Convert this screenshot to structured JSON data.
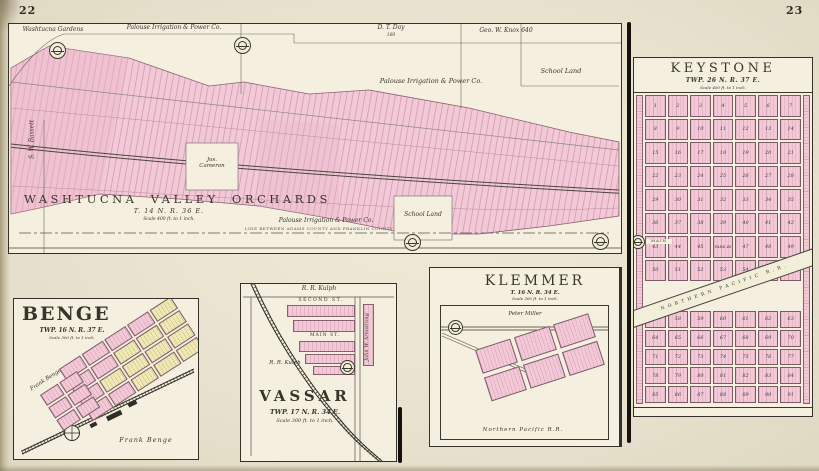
{
  "page": {
    "left_number": "22",
    "right_number": "23"
  },
  "colors": {
    "paper": "#e8e2cf",
    "panel": "#f4efdf",
    "pink": "#f3c9d7",
    "pink_dark": "#eab6c9",
    "yellow": "#efe9b6",
    "ink": "#2e2c24"
  },
  "washtucna": {
    "title": "WASHTUCNA  VALLEY  ORCHARDS",
    "township": "T. 14 N. R. 36 E.",
    "scale": "Scale 400 ft. to 1 inch.",
    "labels": {
      "washtucna_gardens": "Washtucna  Gardens",
      "palouse_top": "Palouse Irrigation & Power Co.",
      "dt_day": "D. T. Day",
      "dt_day_acres": "160",
      "geo_knox": "Geo. W. Knox   640",
      "palouse_mid": "Palouse  Irrigation  &  Power  Co.",
      "school_land_right": "School  Land",
      "jos_cameron_1": "Jos.",
      "jos_cameron_2": "Cameron",
      "school_land_bottom": "School  Land",
      "palouse_bottom": "Palouse Irrigation & Power Co.",
      "sw_bassett": "S. W. Bassett",
      "county_line": "LINE BETWEEN ADAMS COUNTY AND FRANKLIN COUNTY"
    }
  },
  "keystone": {
    "title": "KEYSTONE",
    "township": "TWP. 26 N. R. 37 E.",
    "scale": "Scale 400 ft. to 1 inch.",
    "railroad": "NORTHERN PACIFIC R.R.",
    "main_street": "MAIN",
    "rows_above": [
      [
        "1",
        "2",
        "3",
        "4",
        "5",
        "6",
        "7"
      ],
      [
        "8",
        "9",
        "10",
        "11",
        "12",
        "13",
        "14"
      ],
      [
        "15",
        "16",
        "17",
        "18",
        "19",
        "20",
        "21"
      ],
      [
        "22",
        "23",
        "24",
        "25",
        "26",
        "27",
        "28"
      ],
      [
        "29",
        "30",
        "31",
        "32",
        "33",
        "34",
        "35"
      ],
      [
        "36",
        "37",
        "38",
        "39",
        "40",
        "41",
        "42"
      ],
      [
        "43",
        "44",
        "45",
        "PARK 46",
        "47",
        "48",
        "49"
      ],
      [
        "50",
        "51",
        "52",
        "53",
        "54",
        "55",
        "56"
      ]
    ],
    "rows_below": [
      [
        "57",
        "58",
        "59",
        "60",
        "61",
        "62",
        "63"
      ],
      [
        "64",
        "65",
        "66",
        "67",
        "68",
        "69",
        "70"
      ],
      [
        "71",
        "72",
        "73",
        "74",
        "75",
        "76",
        "77"
      ],
      [
        "78",
        "79",
        "80",
        "81",
        "82",
        "83",
        "84"
      ],
      [
        "85",
        "86",
        "87",
        "88",
        "89",
        "90",
        "91"
      ]
    ]
  },
  "benge": {
    "title": "BENGE",
    "township": "TWP. 16 N. R. 37 E.",
    "scale": "Scale 300 ft. to 1 inch.",
    "owner_left": "Frank  Benge",
    "owner_bottom": "Frank  Benge",
    "blocks": [
      [
        "pink",
        "pink",
        "pink",
        "pink",
        "yellow"
      ],
      [
        "pink",
        "pink",
        "yellow",
        "yellow",
        "yellow"
      ],
      [
        "pink",
        "yellow",
        "yellow",
        "yellow",
        "yellow"
      ],
      [
        "pink",
        "pink",
        "yellow",
        "yellow",
        "yellow"
      ]
    ],
    "tail_blocks": [
      [
        "pink",
        "pink"
      ],
      [
        "pink",
        "pink"
      ],
      [
        "pink",
        "pink"
      ]
    ]
  },
  "vassar": {
    "title": "VASSAR",
    "township": "TWP. 17 N. R. 34 E.",
    "scale": "Scale 300 ft. to 1 inch.",
    "owner_top": "R. R. Kulph",
    "owner_mid": "R. R. Kulph",
    "owner_right": "John W. Armstrong",
    "second_street": "SECOND   ST.",
    "main_street": "MAIN  ST."
  },
  "klemmer": {
    "title": "KLEMMER",
    "township": "T. 16 N. R. 34 E.",
    "scale": "Scale 300 ft. to 1 inch.",
    "owner": "Peter  Miller",
    "railroad": "Northern   Pacific   R.R.",
    "blocks": [
      [
        "pink",
        "pink",
        "pink"
      ],
      [
        "pink",
        "pink",
        "pink"
      ]
    ]
  }
}
